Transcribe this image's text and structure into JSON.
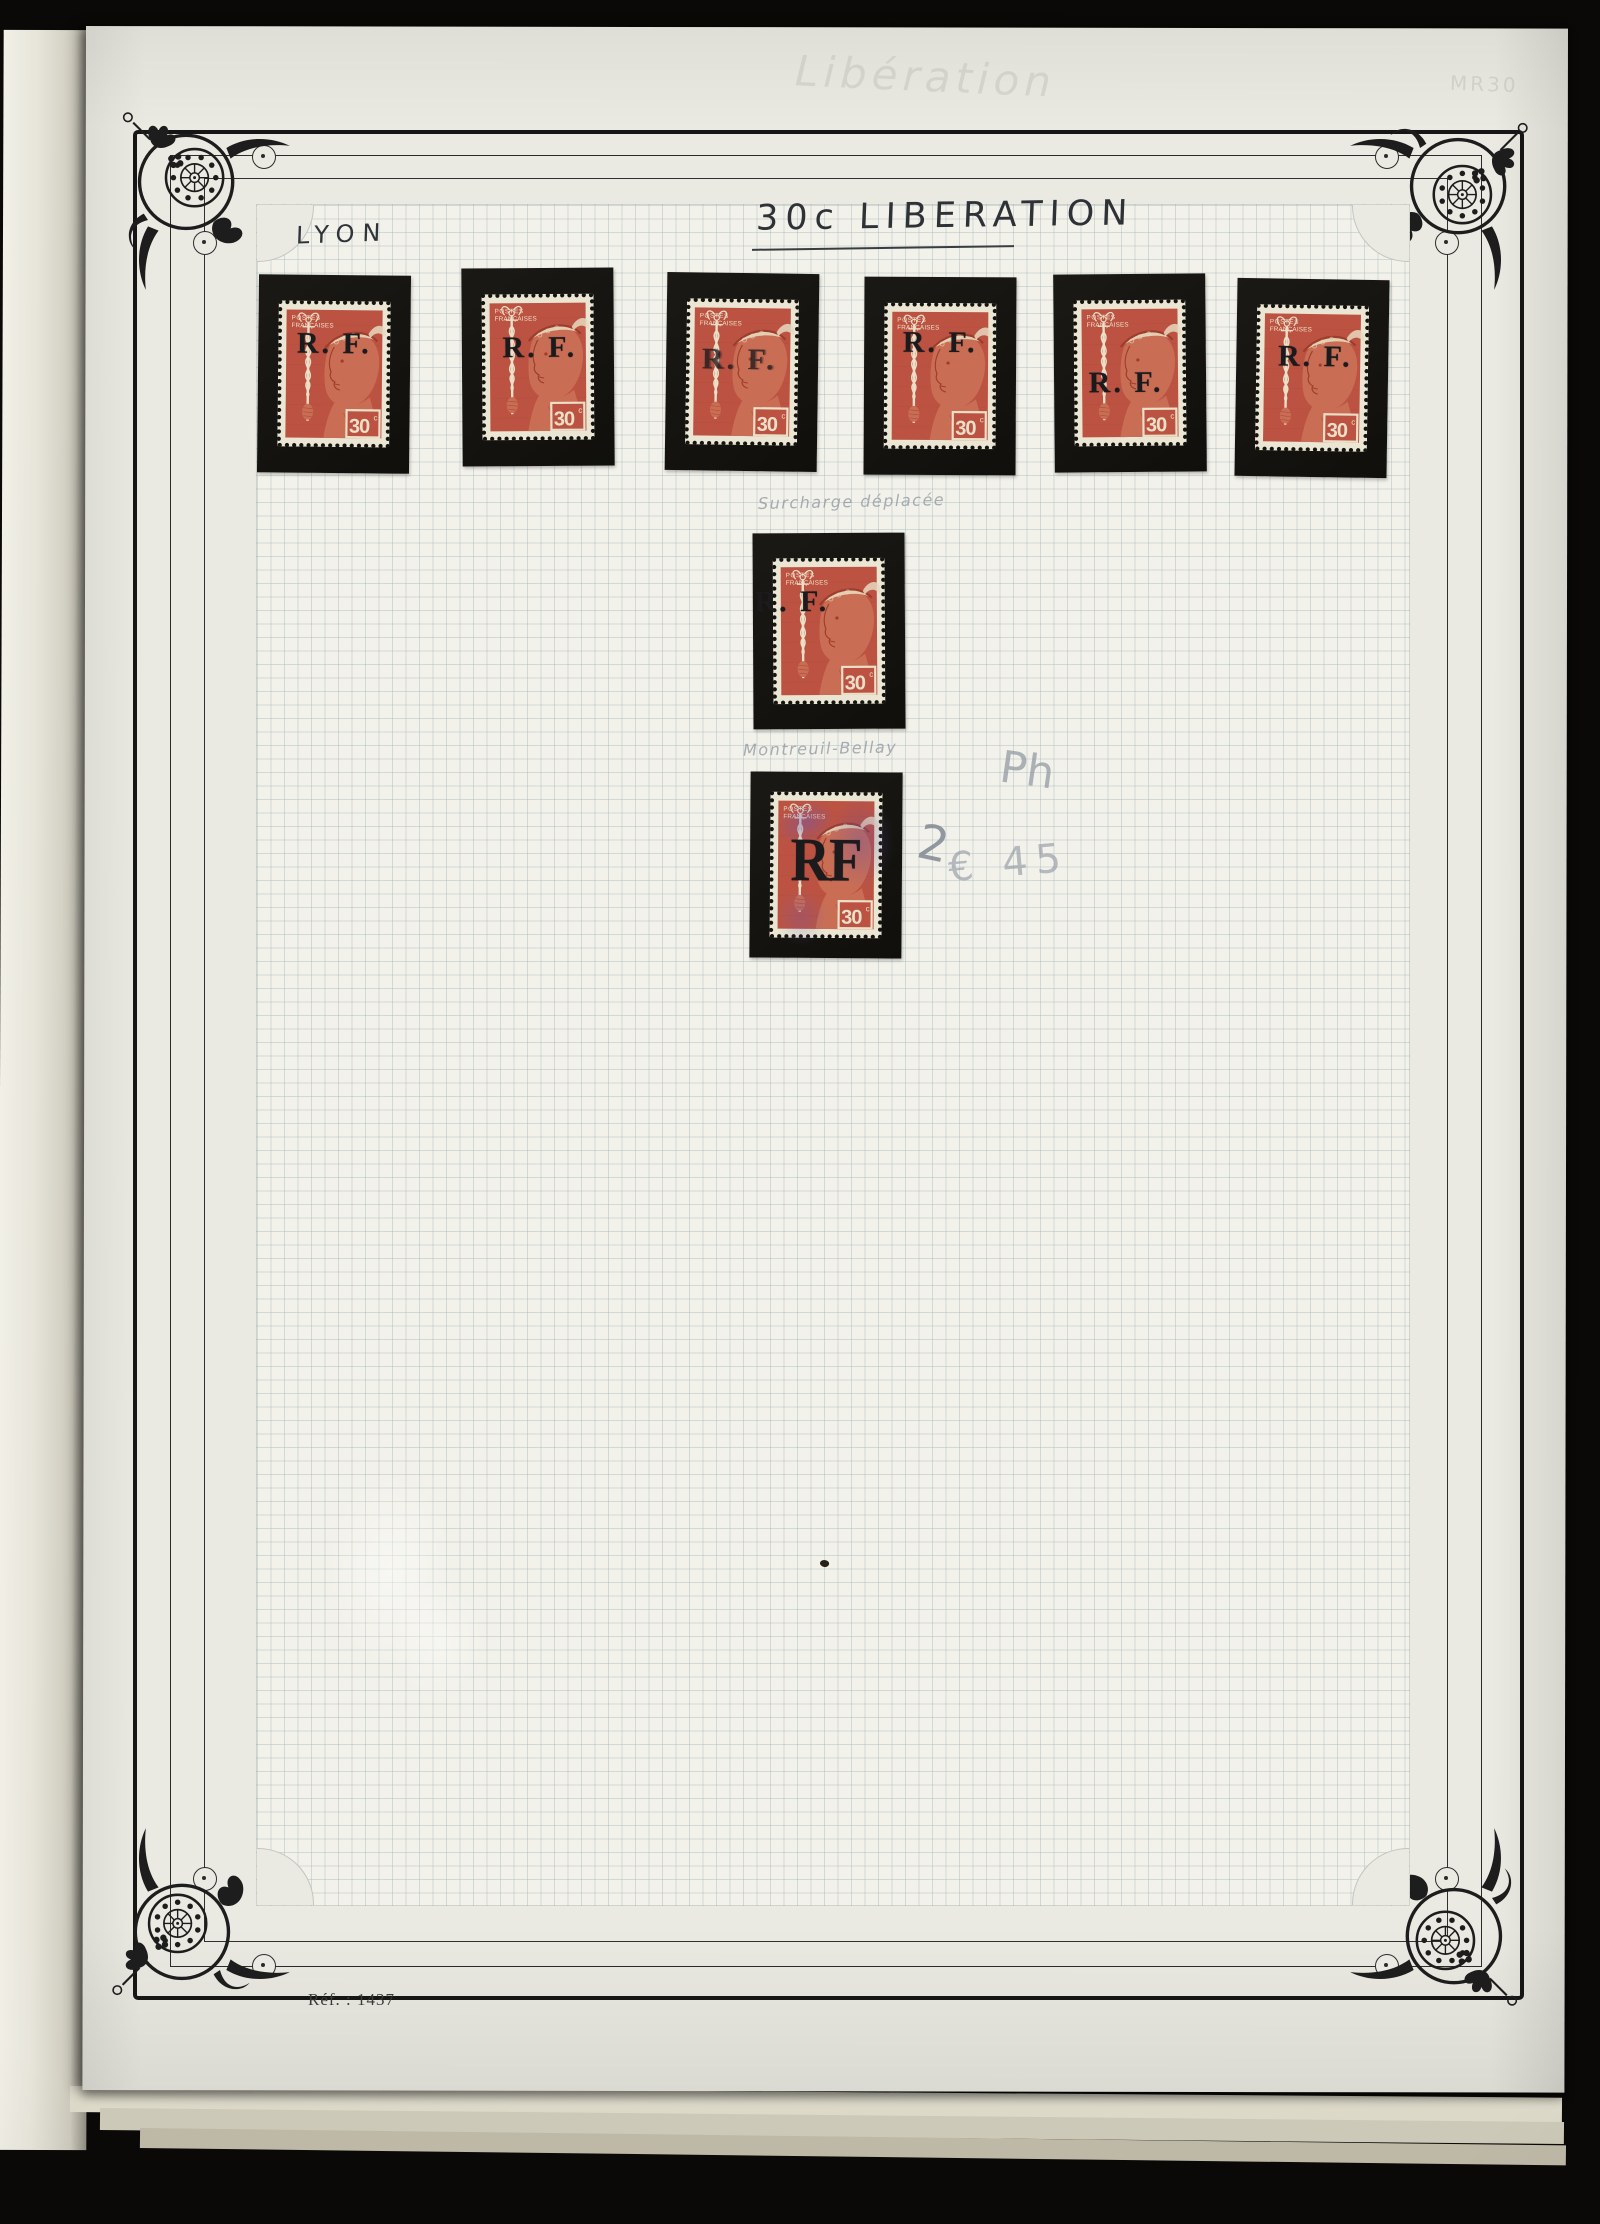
{
  "photo": {
    "background_color": "#0a0908"
  },
  "page": {
    "paper_color": "#ebeae2",
    "title": "30c LIBERATION",
    "region_label": "LYON",
    "ref_text": "Réf. : 1437",
    "margin_note_top": "Libération",
    "margin_note_top_right": "MR30"
  },
  "stamp_design": {
    "country_line1": "POSTES",
    "country_line2": "FRANÇAISES",
    "value": "30",
    "value_unit": "c",
    "colors": {
      "stamp_red": "#bc5342",
      "paper_cream": "#eae6d3",
      "mount_black": "#15130f",
      "overprint_black": "#1b1a1d",
      "cancel_violet": "#6c58b2"
    }
  },
  "overprints": {
    "rf_dotted": "R. F.",
    "rf_large": "RF",
    "row": [
      {
        "dx": 0,
        "dy": -24
      },
      {
        "dx": 2,
        "dy": -13
      },
      {
        "dx": -3,
        "dy": -6,
        "opacity": 0.78,
        "blur": true
      },
      {
        "dx": 0,
        "dy": -27
      },
      {
        "dx": -4,
        "dy": 16
      },
      {
        "dx": 3,
        "dy": -15
      }
    ],
    "shifted_single": {
      "dx": -37,
      "dy": -23
    },
    "large_single": {
      "dx": 0,
      "dy": -4,
      "sx": 0.88
    }
  },
  "annotations": {
    "shifted_overprint_note": "Surcharge déplacée",
    "montreuil_note": "Montreuil-Bellay",
    "pencil_ph": "Ph",
    "pencil_quantity": "2",
    "pencil_price": "€ 45"
  }
}
